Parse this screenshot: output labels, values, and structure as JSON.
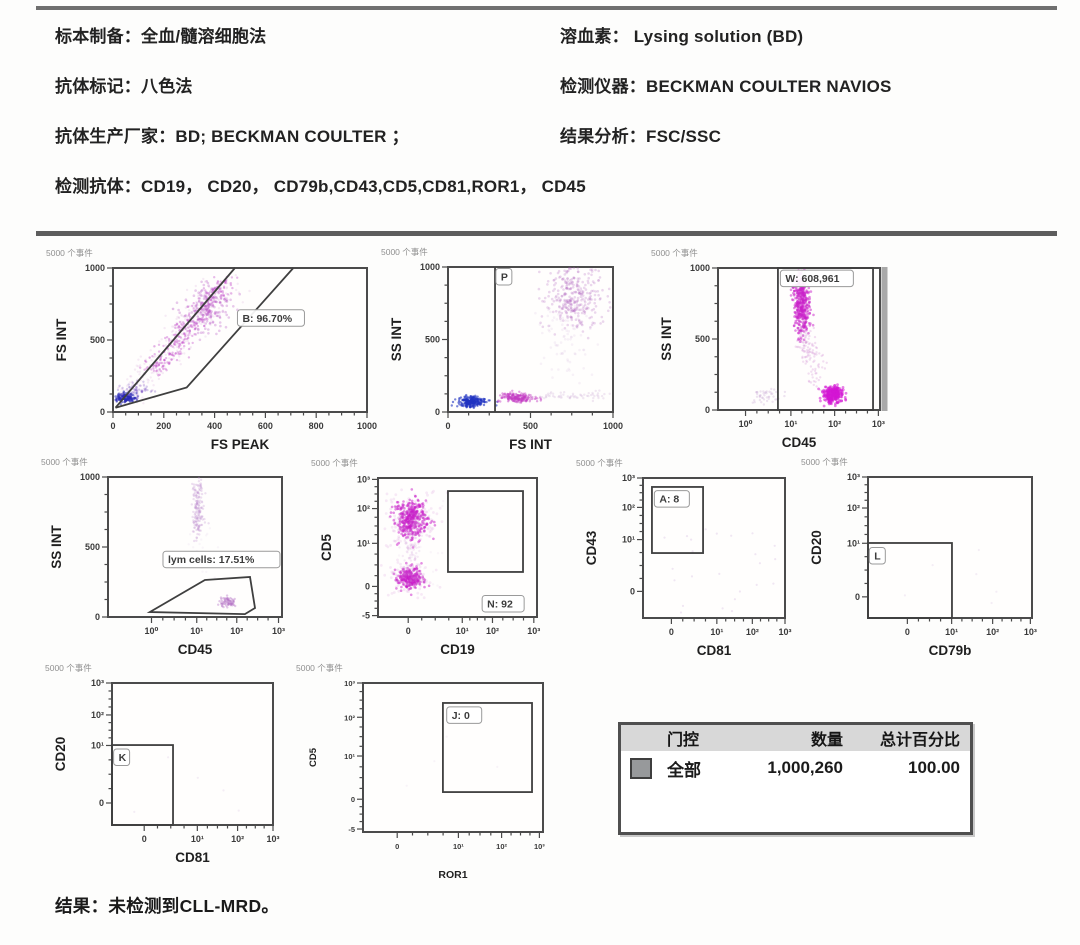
{
  "header": {
    "left_lines": [
      "标本制备：全血/髓溶细胞法",
      "抗体标记：八色法",
      "抗体生产厂家：BD; BECKMAN COULTER ；",
      "检测抗体：CD19， CD20， CD79b,CD43,CD5,CD81,ROR1， CD45"
    ],
    "right_lines": [
      "溶血素： Lysing solution (BD)",
      "检测仪器：BECKMAN COULTER NAVIOS",
      "结果分析：FSC/SSC"
    ]
  },
  "table": {
    "headers": [
      "门控",
      "数量",
      "总计百分比"
    ],
    "rows": [
      {
        "swatch_color": "#97999b",
        "gate": "全部",
        "count": "1,000,260",
        "percent": "100.00"
      }
    ]
  },
  "footer": {
    "result_line": "结果：未检测到CLL-MRD。"
  },
  "colors": {
    "scatter_magenta": "#cc1ecc",
    "scatter_blue": "#2a2ab6",
    "plot_border": "#4b4b4b"
  },
  "chart_data": {
    "type": "scatter",
    "events_label": "5000 个事件",
    "plots": [
      {
        "id": "fsint-vs-fspeak",
        "xlabel": "FS PEAK",
        "ylabel": "FS INT",
        "box": {
          "x": 113,
          "y": 268,
          "w": 254,
          "h": 144
        },
        "xt": [
          [
            "0",
            0
          ],
          [
            "200",
            0.2
          ],
          [
            "400",
            0.4
          ],
          [
            "600",
            0.6
          ],
          [
            "800",
            0.8
          ],
          [
            "1000",
            1
          ]
        ],
        "yt": [
          [
            "1000",
            0
          ],
          [
            "500",
            0.5
          ],
          [
            "0",
            1
          ]
        ],
        "gates": [
          {
            "k": "poly",
            "pts": [
              [
                0.01,
                0.97
              ],
              [
                0.48,
                0.0
              ]
            ]
          },
          {
            "k": "poly",
            "pts": [
              [
                0.01,
                0.97
              ],
              [
                0.29,
                0.83
              ],
              [
                0.71,
                0.0
              ]
            ]
          }
        ],
        "glabels": [
          {
            "t": "B: 96.70%",
            "x": 0.49,
            "y": 0.29
          }
        ],
        "clusters": [
          {
            "k": "band",
            "p0": [
              0.04,
              0.93
            ],
            "p1": [
              0.46,
              0.07
            ],
            "j": [
              0.05,
              0.04
            ],
            "n": 260,
            "c": "#c487cf",
            "o": 0.16,
            "r": 1.2
          },
          {
            "k": "band",
            "p0": [
              0.16,
              0.72
            ],
            "p1": [
              0.45,
              0.09
            ],
            "j": [
              0.027,
              0.022
            ],
            "n": 300,
            "c": "#bd37c5",
            "o": 0.34,
            "r": 1.2
          },
          {
            "k": "gauss",
            "cx": 0.37,
            "cy": 0.28,
            "sx": 0.045,
            "sy": 0.08,
            "n": 170,
            "c": "#b44ec2",
            "o": 0.3,
            "r": 1.3
          },
          {
            "k": "gauss",
            "cx": 0.05,
            "cy": 0.9,
            "sx": 0.02,
            "sy": 0.016,
            "n": 150,
            "c": "#2a2ab6",
            "o": 0.55,
            "r": 1.2
          },
          {
            "k": "gauss",
            "cx": 0.09,
            "cy": 0.85,
            "sx": 0.03,
            "sy": 0.025,
            "n": 60,
            "c": "#7e57c8",
            "o": 0.3,
            "r": 1.2
          }
        ]
      },
      {
        "id": "ssint-vs-fsint",
        "xlabel": "FS INT",
        "ylabel": "SS INT",
        "box": {
          "x": 448,
          "y": 267,
          "w": 165,
          "h": 145
        },
        "xt": [
          [
            "0",
            0
          ],
          [
            "500",
            0.5
          ],
          [
            "1000",
            1
          ]
        ],
        "yt": [
          [
            "1000",
            0
          ],
          [
            "500",
            0.5
          ],
          [
            "0",
            1
          ]
        ],
        "gates": [
          {
            "k": "vline",
            "x": 0.285
          }
        ],
        "glabels": [
          {
            "t": "P",
            "x": 0.29,
            "y": 0.01
          }
        ],
        "clusters": [
          {
            "k": "gauss",
            "cx": 0.15,
            "cy": 0.93,
            "sx": 0.045,
            "sy": 0.018,
            "n": 230,
            "c": "#2233c2",
            "o": 0.6,
            "r": 1.2
          },
          {
            "k": "gauss",
            "cx": 0.42,
            "cy": 0.9,
            "sx": 0.05,
            "sy": 0.018,
            "n": 190,
            "c": "#c33cc3",
            "o": 0.45,
            "r": 1.2
          },
          {
            "k": "gauss",
            "cx": 0.76,
            "cy": 0.2,
            "sx": 0.085,
            "sy": 0.11,
            "n": 330,
            "c": "#b368c0",
            "o": 0.26,
            "r": 1.3
          },
          {
            "k": "gauss",
            "cx": 0.72,
            "cy": 0.5,
            "sx": 0.1,
            "sy": 0.12,
            "n": 80,
            "c": "#c9a2d4",
            "o": 0.14,
            "r": 1.3
          },
          {
            "k": "band",
            "p0": [
              0.55,
              0.89
            ],
            "p1": [
              0.97,
              0.88
            ],
            "j": [
              0.06,
              0.015
            ],
            "n": 60,
            "c": "#c9a2d4",
            "o": 0.25,
            "r": 1.2
          }
        ]
      },
      {
        "id": "ssint-vs-cd45-w",
        "xlabel": "CD45",
        "ylabel": "SS INT",
        "box": {
          "x": 718,
          "y": 268,
          "w": 162,
          "h": 142
        },
        "right_shadow": true,
        "xt": [
          [
            "10⁰",
            0.17
          ],
          [
            "10¹",
            0.45
          ],
          [
            "10²",
            0.72
          ],
          [
            "10³",
            0.99
          ]
        ],
        "yt": [
          [
            "1000",
            0
          ],
          [
            "500",
            0.5
          ],
          [
            "0",
            1
          ]
        ],
        "gates": [
          {
            "k": "rect",
            "x": 0.37,
            "y": 0.0,
            "w": 0.587,
            "h": 1.0
          }
        ],
        "glabels": [
          {
            "t": "W: 608,961",
            "x": 0.385,
            "y": 0.015
          }
        ],
        "clusters": [
          {
            "k": "band",
            "p0": [
              0.51,
              0.1
            ],
            "p1": [
              0.525,
              0.42
            ],
            "j": [
              0.025,
              0.05
            ],
            "n": 380,
            "c": "#ca1fca",
            "o": 0.5,
            "r": 1.3
          },
          {
            "k": "band",
            "p0": [
              0.53,
              0.42
            ],
            "p1": [
              0.62,
              0.78
            ],
            "j": [
              0.03,
              0.06
            ],
            "n": 120,
            "c": "#c46fc8",
            "o": 0.22,
            "r": 1.2
          },
          {
            "k": "gauss",
            "cx": 0.71,
            "cy": 0.89,
            "sx": 0.032,
            "sy": 0.028,
            "n": 260,
            "c": "#d315d3",
            "o": 0.55,
            "r": 1.4
          },
          {
            "k": "gauss",
            "cx": 0.3,
            "cy": 0.9,
            "sx": 0.05,
            "sy": 0.03,
            "n": 45,
            "c": "#c8a6d3",
            "o": 0.3,
            "r": 1.2
          }
        ]
      },
      {
        "id": "ssint-vs-cd45-lym",
        "xlabel": "CD45",
        "ylabel": "SS INT",
        "box": {
          "x": 108,
          "y": 477,
          "w": 174,
          "h": 140
        },
        "xt": [
          [
            "10⁰",
            0.25
          ],
          [
            "10¹",
            0.51
          ],
          [
            "10²",
            0.74
          ],
          [
            "10³",
            0.98
          ]
        ],
        "yt": [
          [
            "1000",
            0
          ],
          [
            "500",
            0.5
          ],
          [
            "0",
            1
          ]
        ],
        "gates": [
          {
            "k": "poly",
            "pts": [
              [
                0.241,
                0.964
              ],
              [
                0.557,
                0.736
              ],
              [
                0.816,
                0.714
              ],
              [
                0.845,
                0.936
              ],
              [
                0.787,
                0.979
              ]
            ],
            "close": true
          }
        ],
        "glabels": [
          {
            "t": "lym cells: 17.51%",
            "x": 0.316,
            "y": 0.53
          }
        ],
        "clusters": [
          {
            "k": "band",
            "p0": [
              0.52,
              0.02
            ],
            "p1": [
              0.52,
              0.4
            ],
            "j": [
              0.018,
              0.05
            ],
            "n": 170,
            "c": "#bf8ecf",
            "o": 0.28,
            "r": 1.2
          },
          {
            "k": "gauss",
            "cx": 0.69,
            "cy": 0.89,
            "sx": 0.022,
            "sy": 0.018,
            "n": 70,
            "c": "#b374c5",
            "o": 0.4,
            "r": 1.2
          },
          {
            "k": "gauss",
            "cx": 0.54,
            "cy": 0.55,
            "sx": 0.05,
            "sy": 0.07,
            "n": 25,
            "c": "#d8c2e2",
            "o": 0.15,
            "r": 1.2
          }
        ]
      },
      {
        "id": "cd5-vs-cd19",
        "xlabel": "CD19",
        "ylabel": "CD5",
        "box": {
          "x": 378,
          "y": 478,
          "w": 159,
          "h": 139
        },
        "xt": [
          [
            "0",
            0.19
          ],
          [
            "10¹",
            0.53
          ],
          [
            "10²",
            0.72
          ],
          [
            "10³",
            0.98
          ]
        ],
        "yt": [
          [
            "10³",
            0.01
          ],
          [
            "10²",
            0.22
          ],
          [
            "10¹",
            0.47
          ],
          [
            "0",
            0.78
          ],
          [
            "-5",
            0.99
          ]
        ],
        "gates": [
          {
            "k": "rect",
            "x": 0.44,
            "y": 0.094,
            "w": 0.472,
            "h": 0.582
          }
        ],
        "glabels": [
          {
            "t": "N: 92",
            "x": 0.655,
            "y": 0.845
          }
        ],
        "clusters": [
          {
            "k": "gauss",
            "cx": 0.21,
            "cy": 0.3,
            "sx": 0.05,
            "sy": 0.07,
            "n": 380,
            "c": "#ca1cca",
            "o": 0.5,
            "r": 1.3
          },
          {
            "k": "gauss",
            "cx": 0.21,
            "cy": 0.3,
            "sx": 0.08,
            "sy": 0.1,
            "n": 180,
            "c": "#cf7fd5",
            "o": 0.16,
            "r": 1.4
          },
          {
            "k": "gauss",
            "cx": 0.2,
            "cy": 0.72,
            "sx": 0.04,
            "sy": 0.04,
            "n": 240,
            "c": "#ca1cca",
            "o": 0.5,
            "r": 1.3
          },
          {
            "k": "gauss",
            "cx": 0.2,
            "cy": 0.72,
            "sx": 0.06,
            "sy": 0.06,
            "n": 110,
            "c": "#cf7fd5",
            "o": 0.16,
            "r": 1.4
          },
          {
            "k": "band",
            "p0": [
              0.2,
              0.44
            ],
            "p1": [
              0.21,
              0.62
            ],
            "j": [
              0.035,
              0.05
            ],
            "n": 60,
            "c": "#d4a2dc",
            "o": 0.2,
            "r": 1.2
          },
          {
            "k": "uniform",
            "x0": 0.1,
            "y0": 0.15,
            "x1": 0.42,
            "y1": 0.8,
            "n": 25,
            "c": "#dcc0e4",
            "o": 0.15,
            "r": 1.2
          }
        ]
      },
      {
        "id": "cd43-vs-cd81",
        "xlabel": "CD81",
        "ylabel": "CD43",
        "box": {
          "x": 643,
          "y": 478,
          "w": 142,
          "h": 140
        },
        "xt": [
          [
            "0",
            0.2
          ],
          [
            "10¹",
            0.52
          ],
          [
            "10²",
            0.77
          ],
          [
            "10³",
            1.0
          ]
        ],
        "yt": [
          [
            "10³",
            0
          ],
          [
            "10²",
            0.21
          ],
          [
            "10¹",
            0.44
          ],
          [
            "0",
            0.81
          ]
        ],
        "gates": [
          {
            "k": "rect",
            "x": 0.063,
            "y": 0.064,
            "w": 0.36,
            "h": 0.472
          }
        ],
        "glabels": [
          {
            "t": "A: 8",
            "x": 0.08,
            "y": 0.09
          }
        ],
        "clusters": [
          {
            "k": "uniform",
            "x0": 0.15,
            "y0": 0.35,
            "x1": 0.95,
            "y1": 0.97,
            "n": 24,
            "c": "#d9c4e3",
            "o": 0.4,
            "r": 1.1
          }
        ]
      },
      {
        "id": "cd20-vs-cd79b",
        "xlabel": "CD79b",
        "ylabel": "CD20",
        "box": {
          "x": 868,
          "y": 477,
          "w": 164,
          "h": 141
        },
        "xt": [
          [
            "0",
            0.24
          ],
          [
            "10¹",
            0.51
          ],
          [
            "10²",
            0.76
          ],
          [
            "10³",
            0.99
          ]
        ],
        "yt": [
          [
            "10³",
            0
          ],
          [
            "10²",
            0.22
          ],
          [
            "10¹",
            0.47
          ],
          [
            "0",
            0.85
          ]
        ],
        "gates": [
          {
            "k": "rect",
            "x": 0.0,
            "y": 0.468,
            "w": 0.512,
            "h": 0.532
          }
        ],
        "glabels": [
          {
            "t": "L",
            "x": 0.008,
            "y": 0.5
          }
        ],
        "clusters": [
          {
            "k": "uniform",
            "x0": 0.1,
            "y0": 0.5,
            "x1": 0.8,
            "y1": 0.95,
            "n": 6,
            "c": "#dcc8e6",
            "o": 0.3,
            "r": 1.1
          }
        ]
      },
      {
        "id": "cd20-vs-cd81",
        "xlabel": "CD81",
        "ylabel": "CD20",
        "box": {
          "x": 112,
          "y": 683,
          "w": 161,
          "h": 142
        },
        "xt": [
          [
            "0",
            0.2
          ],
          [
            "10¹",
            0.53
          ],
          [
            "10²",
            0.78
          ],
          [
            "10³",
            1.0
          ]
        ],
        "yt": [
          [
            "10³",
            0
          ],
          [
            "10²",
            0.225
          ],
          [
            "10¹",
            0.44
          ],
          [
            "0",
            0.845
          ]
        ],
        "gates": [
          {
            "k": "rect",
            "x": 0.0,
            "y": 0.437,
            "w": 0.379,
            "h": 0.563
          }
        ],
        "glabels": [
          {
            "t": "K",
            "x": 0.01,
            "y": 0.465
          }
        ],
        "clusters": [
          {
            "k": "uniform",
            "x0": 0.1,
            "y0": 0.5,
            "x1": 0.8,
            "y1": 0.95,
            "n": 5,
            "c": "#dcc8e6",
            "o": 0.3,
            "r": 1.1
          }
        ]
      },
      {
        "id": "cd5-vs-ror1",
        "xlabel": "ROR1",
        "ylabel": "CD5",
        "box": {
          "x": 363,
          "y": 683,
          "w": 180,
          "h": 149
        },
        "small_fonts": true,
        "xt": [
          [
            "0",
            0.19
          ],
          [
            "10¹",
            0.53
          ],
          [
            "10²",
            0.77
          ],
          [
            "10³",
            0.98
          ]
        ],
        "yt": [
          [
            "10³",
            0
          ],
          [
            "10²",
            0.23
          ],
          [
            "10¹",
            0.49
          ],
          [
            "0",
            0.78
          ],
          [
            "-5",
            0.98
          ]
        ],
        "gates": [
          {
            "k": "rect",
            "x": 0.444,
            "y": 0.134,
            "w": 0.495,
            "h": 0.598
          }
        ],
        "glabels": [
          {
            "t": "J: 0",
            "x": 0.465,
            "y": 0.16
          }
        ],
        "clusters": [
          {
            "k": "uniform",
            "x0": 0.2,
            "y0": 0.3,
            "x1": 0.8,
            "y1": 0.9,
            "n": 4,
            "c": "#e2d4ea",
            "o": 0.25,
            "r": 1.1
          }
        ]
      }
    ]
  }
}
